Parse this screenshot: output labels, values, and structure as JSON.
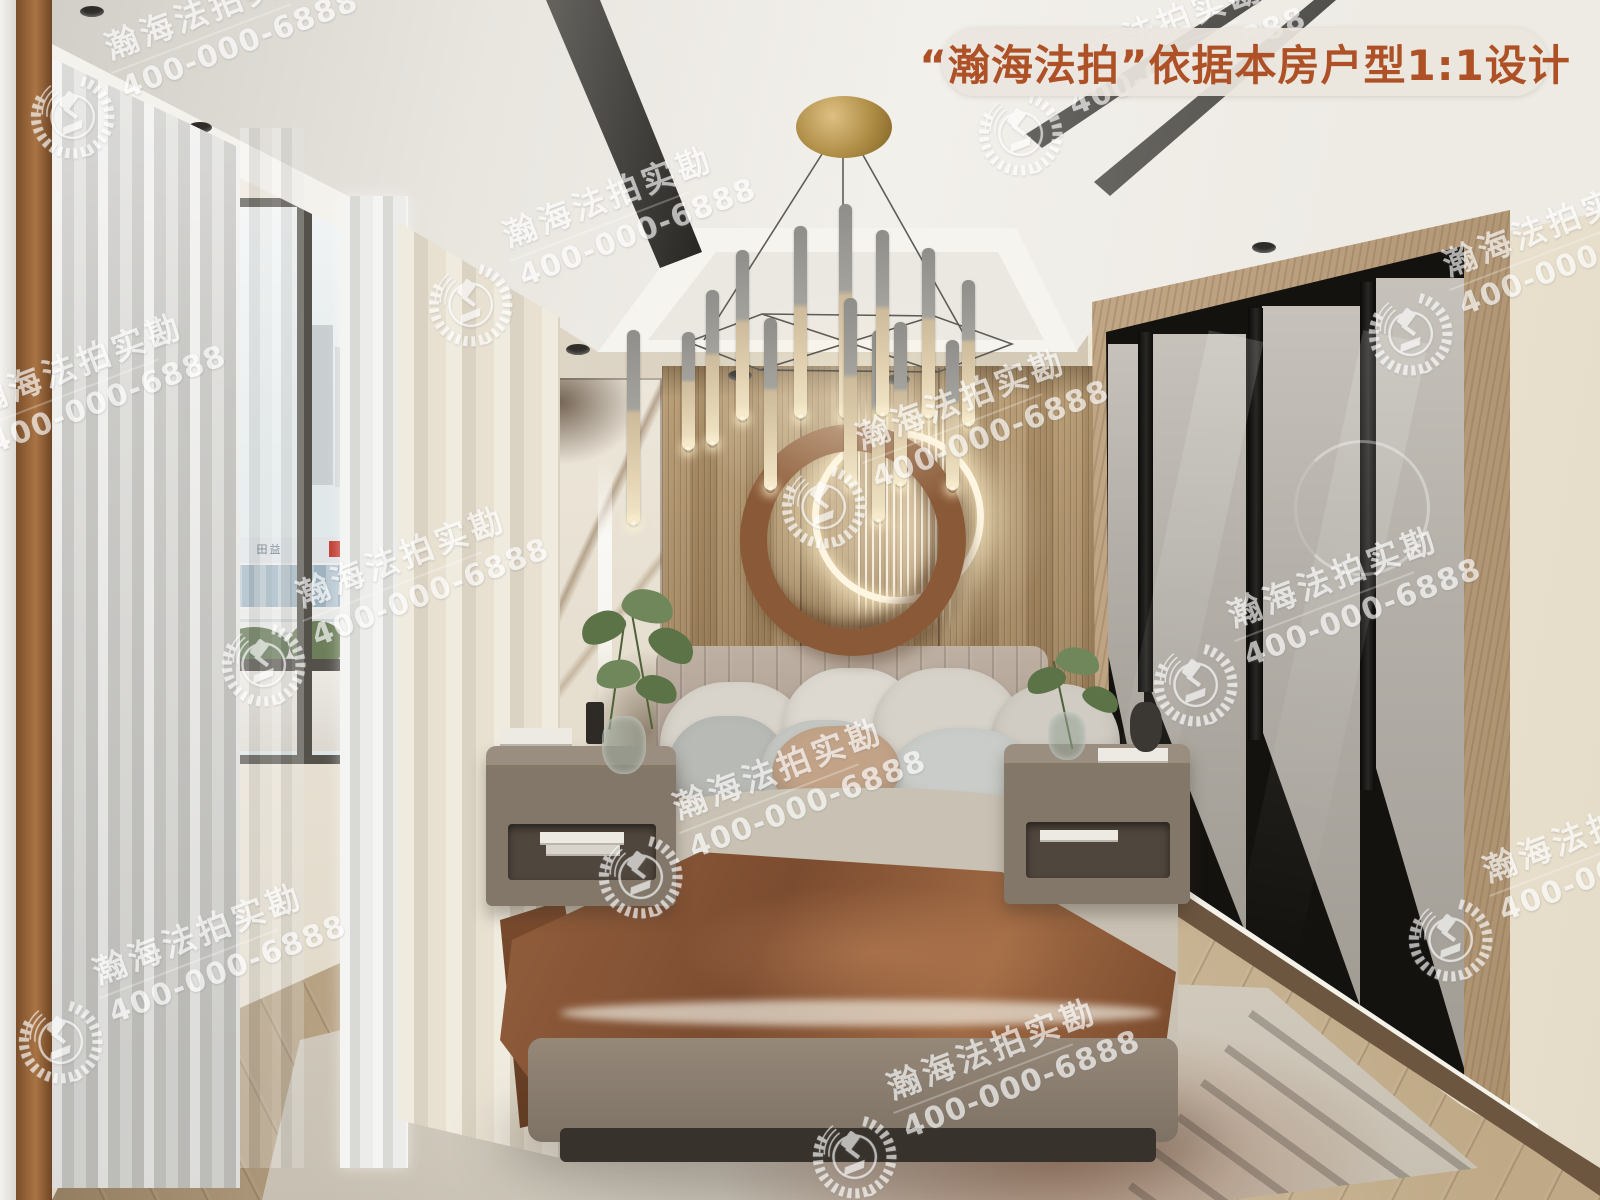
{
  "meta": {
    "kind": "real-estate auction interior photo (3D render)",
    "room": "bedroom",
    "width": 1600,
    "height": 1200
  },
  "badge": {
    "label": "“瀚海法拍”依据本房户型1:1设计",
    "text_color": "#ae5126",
    "bg_color": "rgba(234,230,222,0.92)"
  },
  "watermark": {
    "brand_line": "瀚海法拍实勘",
    "phone_line": "400-000-6888",
    "logo": "gavel-laurel-wreath-emblem",
    "color": "#ffffff",
    "opacity": 0.66,
    "angle_deg": -21,
    "positions": [
      [
        72,
        115
      ],
      [
        1020,
        132
      ],
      [
        470,
        303
      ],
      [
        1410,
        332
      ],
      [
        -60,
        470
      ],
      [
        823,
        505
      ],
      [
        263,
        663
      ],
      [
        1195,
        683
      ],
      [
        640,
        875
      ],
      [
        1450,
        938
      ],
      [
        60,
        1040
      ],
      [
        854,
        1155
      ]
    ]
  },
  "window_view": {
    "building_sign": "田益"
  },
  "palette": {
    "ceiling": "#efece7",
    "wood_wall": "#a1855f",
    "right_wall": "#eae2d0",
    "floor": "#c9b896",
    "throw_blanket": "#8a5636",
    "gold_canopy": "#ab8a42",
    "wardrobe_glass": "#b3afa8"
  }
}
